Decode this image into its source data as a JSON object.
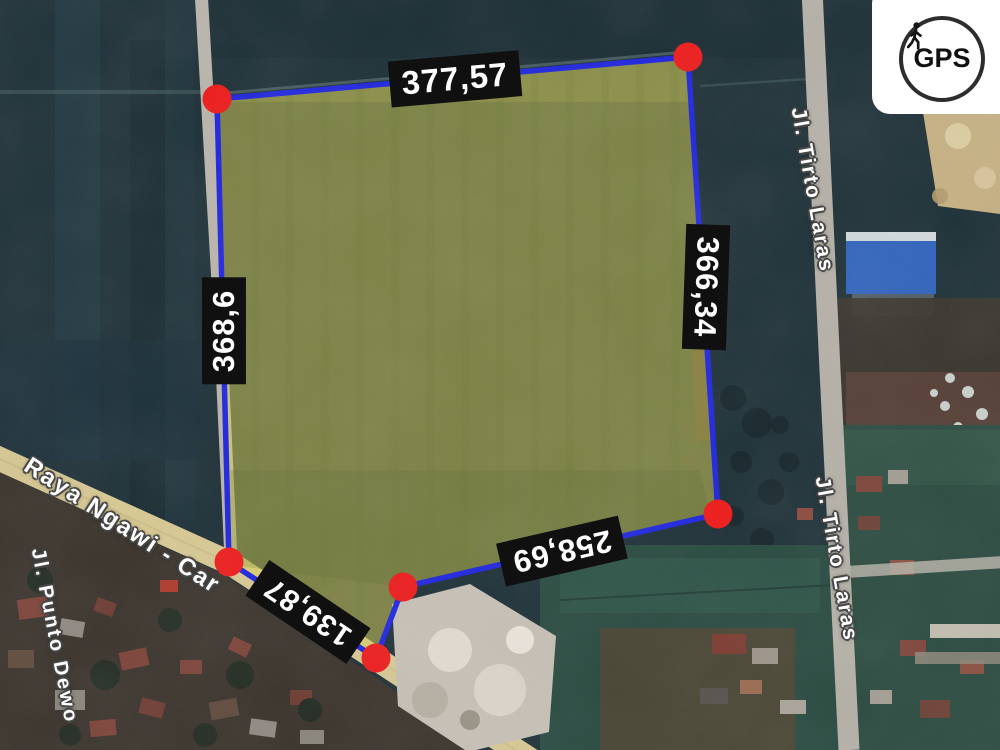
{
  "meta": {
    "description": "Satellite map advertisement of a land parcel with GPS-measured side lengths",
    "location_hint": "Ngawi area, roads: Raya Ngawi - Car..., Jl. Punto Dewo, Jl. Tirto Laras"
  },
  "parcel": {
    "fill_color": "#dcd351",
    "outline_color": "#2026df",
    "vertex_marker_color": "#ee1c1c",
    "vertex_count": 6,
    "vertices_px": [
      [
        217,
        99
      ],
      [
        688,
        57
      ],
      [
        718,
        514
      ],
      [
        403,
        587
      ],
      [
        376,
        658
      ],
      [
        229,
        562
      ]
    ],
    "measurements": {
      "top": "377,57",
      "right": "366,34",
      "left": "368,6",
      "bottom": "258,69",
      "bottom_left": "139,87"
    }
  },
  "roads": [
    {
      "name": "Raya Ngawi - Car"
    },
    {
      "name": "Jl. Punto Dewo"
    },
    {
      "name": "Jl. Tirto Laras"
    },
    {
      "name": "Jl. Tirto Laras"
    }
  ],
  "badge": {
    "label": "GPS",
    "icon": "walking-person-icon"
  }
}
